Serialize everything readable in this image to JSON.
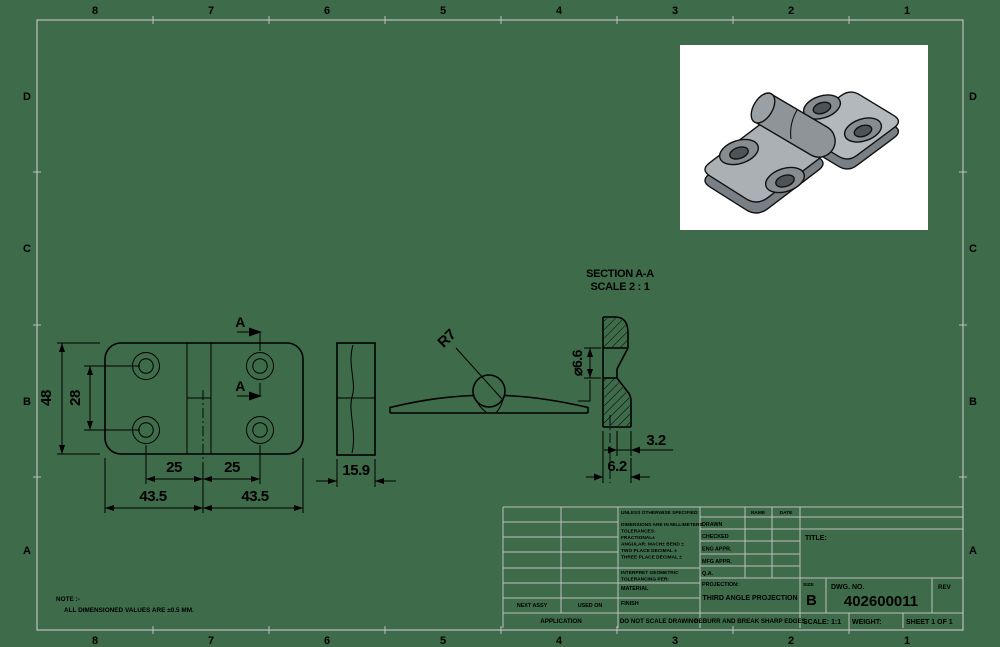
{
  "sheet": {
    "bg_color": "#3E6B4A",
    "border_color": "#BFBFBF",
    "line_color": "#000000",
    "zone_columns": [
      "8",
      "7",
      "6",
      "5",
      "4",
      "3",
      "2",
      "1"
    ],
    "zone_rows": [
      "D",
      "C",
      "B",
      "A"
    ]
  },
  "note": {
    "title": "NOTE :-",
    "body": "ALL DIMENSIONED VALUES ARE ±0.5 MM."
  },
  "front_view": {
    "dim_height": "48",
    "dim_hole_vspacing": "28",
    "dim_hole_left": "25",
    "dim_hole_right": "25",
    "dim_width_left": "43.5",
    "dim_width_right": "43.5",
    "section_letter": "A"
  },
  "side_view": {
    "dim_width": "15.9"
  },
  "profile_view": {
    "dim_radius": "R7"
  },
  "section_view": {
    "title": "SECTION A-A",
    "scale": "SCALE 2 : 1",
    "dim_hole_dia": "⌀6.6",
    "dim_tail_offset": "3.2",
    "dim_tail_width": "6.2"
  },
  "title_block": {
    "tolerance_header": "UNLESS OTHERWISE SPECIFIED:",
    "tolerance_lines": [
      "DIMENSIONS ARE IN MILLIMETERS",
      "TOLERANCES:",
      "FRACTIONAL±",
      "ANGULAR: MACH±   BEND ±",
      "TWO PLACE DECIMAL    ±",
      "THREE PLACE DECIMAL  ±"
    ],
    "interpret_line1": "INTERPRET GEOMETRIC",
    "interpret_line2": "TOLERANCING PER:",
    "material_label": "MATERIAL",
    "finish_label": "FINISH",
    "name_col": "NAME",
    "date_col": "DATE",
    "approval_rows": [
      "DRAWN",
      "CHECKED",
      "ENG APPR.",
      "MFG APPR.",
      "Q.A."
    ],
    "projection_label": "PROJECTION:",
    "projection_value": "THIRD ANGLE PROJECTION",
    "next_assy": "NEXT ASSY",
    "used_on": "USED ON",
    "application": "APPLICATION",
    "do_not_scale": "DO NOT SCALE DRAWING",
    "deburr": "DEBURR AND BREAK SHARP EDGES",
    "title_label": "TITLE:",
    "size_label": "SIZE",
    "size_value": "B",
    "dwg_label": "DWG. NO.",
    "dwg_number": "402600011",
    "rev_label": "REV",
    "scale_label": "SCALE: 1:1",
    "weight_label": "WEIGHT:",
    "sheet_label": "SHEET 1 OF 1"
  }
}
